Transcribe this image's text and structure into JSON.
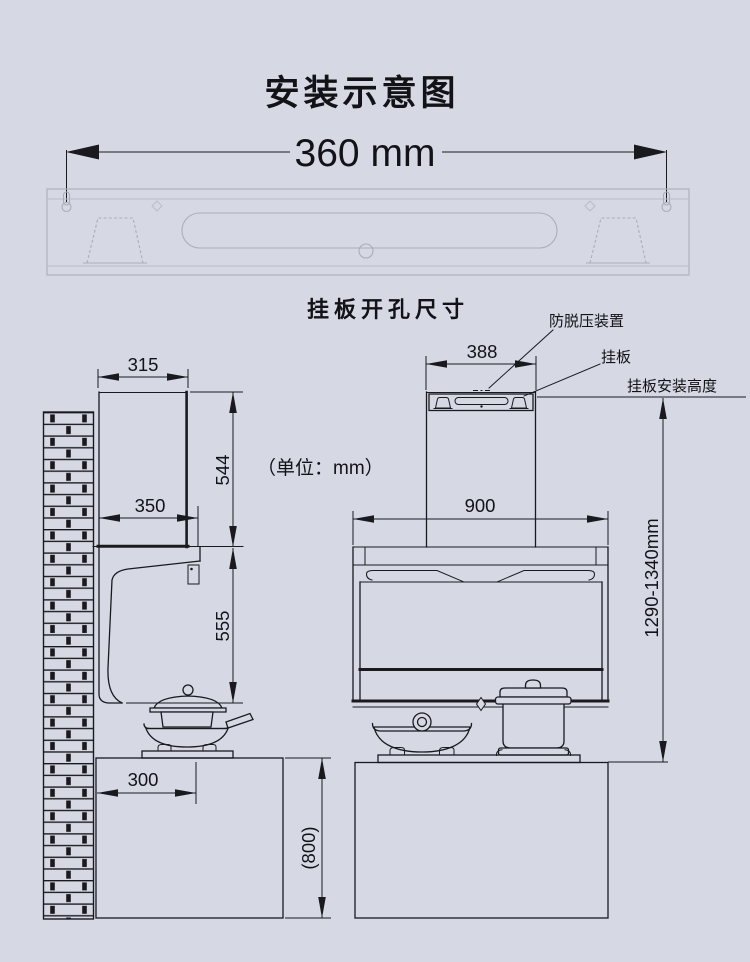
{
  "colors": {
    "background": "#d6d9e4",
    "line": "#1a1a1e",
    "faint_plate_line": "#a9aebc"
  },
  "header": {
    "title": "安装示意图",
    "hole_pitch": "360 mm",
    "plate_caption": "挂板开孔尺寸",
    "unit_note": "（单位：mm）"
  },
  "callouts": {
    "anti_release_device": "防脱压装置",
    "hanging_plate": "挂板",
    "install_height_label": "挂板安装高度"
  },
  "dimensions": {
    "side_chimney_width": "315",
    "side_chimney_height": "544",
    "side_hood_depth": "350",
    "side_hood_height": "555",
    "side_counter_offset": "300",
    "side_counter_height": "(800)",
    "front_chimney_width": "388",
    "front_hood_width": "900",
    "front_install_height": "1290-1340mm"
  }
}
